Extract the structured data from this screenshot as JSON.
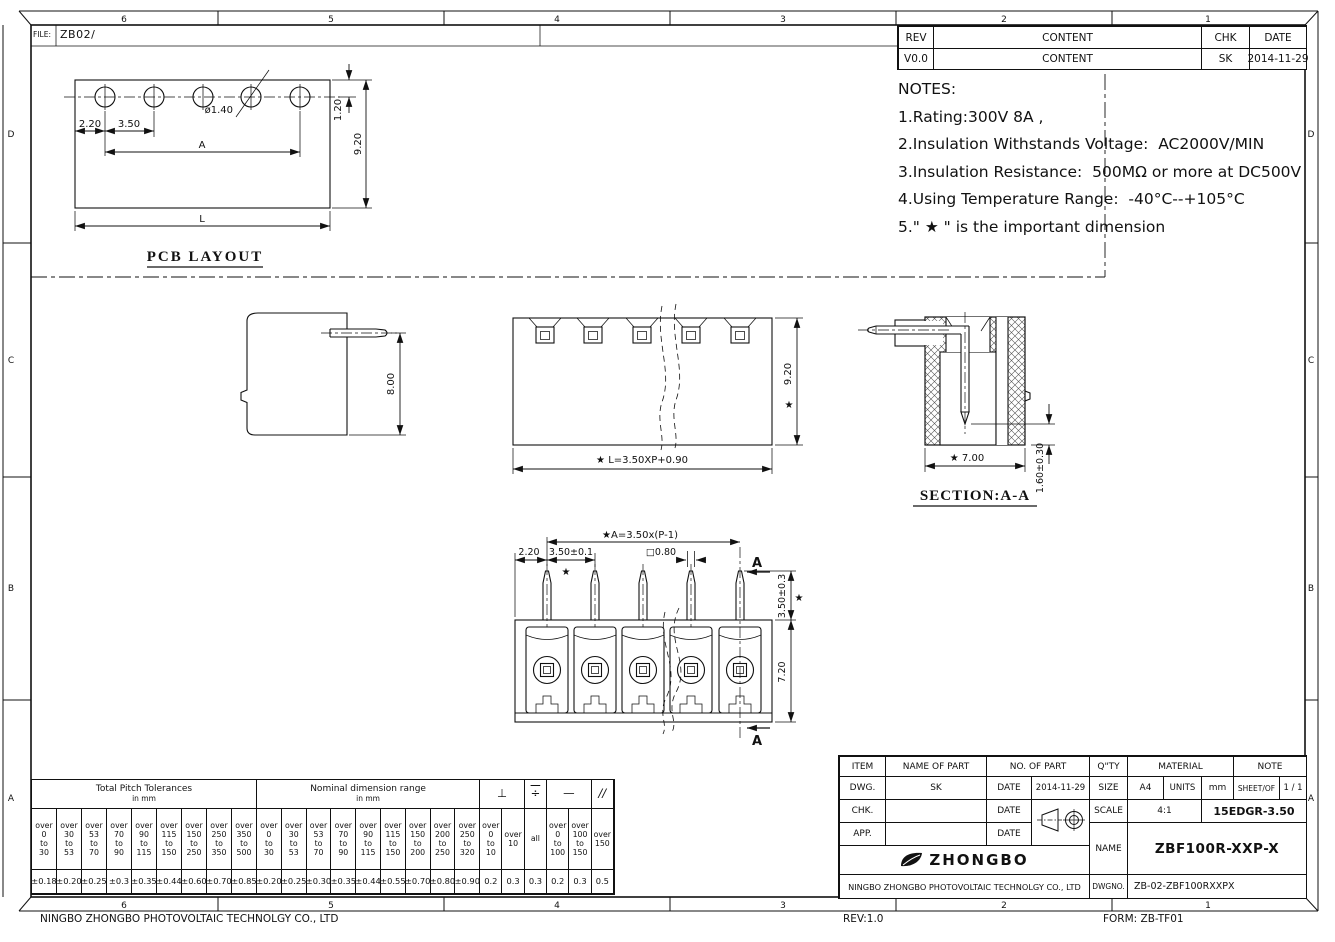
{
  "sheet": {
    "file_label": "FILE:",
    "file_value": "ZB02/",
    "zones_top": [
      "6",
      "5",
      "4",
      "3",
      "2",
      "1"
    ],
    "zones_bottom": [
      "6",
      "5",
      "4",
      "3",
      "2",
      "1"
    ],
    "zones_left": [
      "D",
      "C",
      "B",
      "A"
    ],
    "zones_right": [
      "D",
      "C",
      "B",
      "A"
    ],
    "footer_company": "NINGBO ZHONGBO PHOTOVOLTAIC TECHNOLGY CO., LTD",
    "footer_rev": "REV:1.0",
    "footer_form": "FORM: ZB-TF01"
  },
  "rev_table": {
    "col_rev": "REV",
    "col_content": "CONTENT",
    "col_chk": "CHK",
    "col_date": "DATE",
    "row_rev": "V0.0",
    "row_content": "CONTENT",
    "row_chk": "SK",
    "row_date": "2014-11-29"
  },
  "notes": {
    "title": "NOTES:",
    "lines": [
      "1.Rating:300V 8A ,",
      "2.Insulation Withstands Voltage:  AC2000V/MIN",
      "3.Insulation Resistance:  500MΩ or more at DC500V",
      "4.Using Temperature Range:  -40°C--+105°C",
      "5.\" ★ \" is the important dimension"
    ]
  },
  "views": {
    "pcb": {
      "title": "PCB LAYOUT",
      "d1": "2.20",
      "d2": "3.50",
      "d3": "A",
      "d4": "ø1.40",
      "d5": "1.20",
      "d6": "9.20",
      "d7": "L"
    },
    "side": {
      "d1": "8.00"
    },
    "front": {
      "d1": "9.20",
      "star": "★",
      "d2": "★ L=3.50XP+0.90"
    },
    "section": {
      "title": "SECTION:A-A",
      "d1": "★ 7.00",
      "d2": "1.60±0.30"
    },
    "top": {
      "d1": "★A=3.50x(P-1)",
      "d2": "2.20",
      "d3": "3.50±0.1",
      "d4": "□0.80",
      "d5": "3.50±0.3",
      "d6": "7.20",
      "star": "★",
      "sec": "A"
    }
  },
  "tol_table": {
    "pitch_title": [
      "Total Pitch Tolerances",
      "in mm"
    ],
    "nominal_title": [
      "Nominal dimension range",
      "in mm"
    ],
    "pitch_heads": [
      [
        "over",
        "0",
        "to",
        "30"
      ],
      [
        "over",
        "30",
        "to",
        "53"
      ],
      [
        "over",
        "53",
        "to",
        "70"
      ],
      [
        "over",
        "70",
        "to",
        "90"
      ],
      [
        "over",
        "90",
        "to",
        "115"
      ],
      [
        "over",
        "115",
        "to",
        "150"
      ],
      [
        "over",
        "150",
        "to",
        "250"
      ],
      [
        "over",
        "250",
        "to",
        "350"
      ],
      [
        "over",
        "350",
        "to",
        "500"
      ]
    ],
    "pitch_vals": [
      "±0.18",
      "±0.20",
      "±0.25",
      "±0.3",
      "±0.35",
      "±0.44",
      "±0.60",
      "±0.70",
      "±0.85"
    ],
    "nominal_heads": [
      [
        "over",
        "0",
        "to",
        "30"
      ],
      [
        "over",
        "30",
        "to",
        "53"
      ],
      [
        "over",
        "53",
        "to",
        "70"
      ],
      [
        "over",
        "70",
        "to",
        "90"
      ],
      [
        "over",
        "90",
        "to",
        "115"
      ],
      [
        "over",
        "115",
        "to",
        "150"
      ],
      [
        "over",
        "150",
        "to",
        "200"
      ],
      [
        "over",
        "200",
        "to",
        "250"
      ],
      [
        "over",
        "250",
        "to",
        "320"
      ]
    ],
    "nominal_vals": [
      "±0.20",
      "±0.25",
      "±0.30",
      "±0.35",
      "±0.44",
      "±0.55",
      "±0.70",
      "±0.80",
      "±0.90"
    ],
    "geo_syms": [
      "⊥",
      "÷",
      "—",
      "//"
    ],
    "geo_heads": [
      [
        "over",
        "0",
        "to",
        "10"
      ],
      [
        "over",
        "10"
      ],
      [
        "all"
      ],
      [
        "over",
        "0",
        "to",
        "100"
      ],
      [
        "over",
        "100",
        "to",
        "150"
      ],
      [
        "over",
        "150"
      ]
    ],
    "geo_vals": [
      "0.2",
      "0.3",
      "0.3",
      "0.2",
      "0.3",
      "0.5"
    ]
  },
  "title_block": {
    "item": "ITEM",
    "name_of_part": "NAME OF PART",
    "no_of_part": "NO. OF PART",
    "qty": "Q\"TY",
    "material": "MATERIAL",
    "note": "NOTE",
    "dwg": "DWG.",
    "dwg_name": "SK",
    "date_label": "DATE",
    "dwg_date": "2014-11-29",
    "size_label": "SIZE",
    "size_value": "A4",
    "units_label": "UNITS",
    "units_value": "mm",
    "sheet_label": "SHEET/OF",
    "sheet_value": "1 / 1",
    "chk": "CHK.",
    "scale_label": "SCALE",
    "scale_value": "4:1",
    "series": "15EDGR-3.50",
    "app": "APP.",
    "name_label": "NAME",
    "name_value": "ZBF100R-XXP-X",
    "logo_text": "ZHONGBO",
    "company": "NINGBO ZHONGBO PHOTOVOLTAIC TECHNOLGY CO., LTD",
    "dwgno_label": "DWGNO.",
    "dwgno_value": "ZB-02-ZBF100RXXPX"
  }
}
